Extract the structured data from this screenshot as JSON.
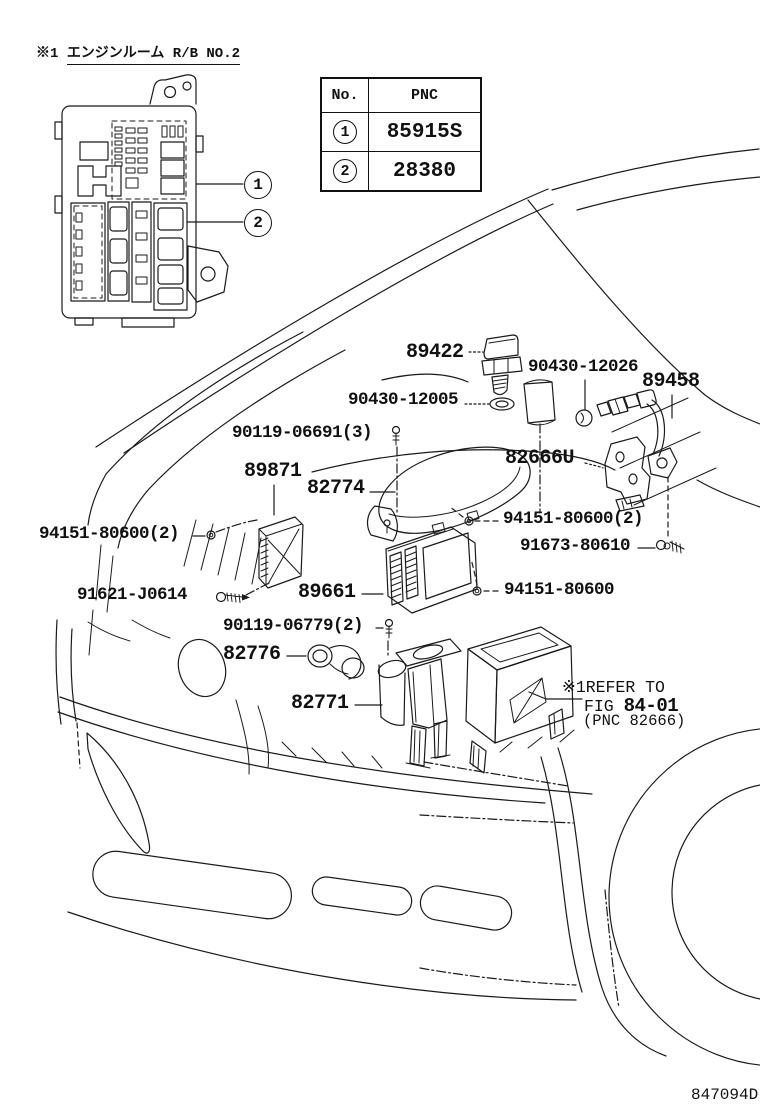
{
  "header": {
    "prefix": "※1",
    "title": "エンジンルーム R/B NO.2"
  },
  "table": {
    "col_no": "No.",
    "col_pnc": "PNC",
    "rows": [
      {
        "no": "1",
        "pnc": "85915S"
      },
      {
        "no": "2",
        "pnc": "28380"
      }
    ]
  },
  "callouts": {
    "c1": "1",
    "c2": "2"
  },
  "part_labels": [
    {
      "id": "89422",
      "text": "89422",
      "x": 406,
      "y": 343,
      "size": "big"
    },
    {
      "id": "90430-12026",
      "text": "90430-12026",
      "x": 528,
      "y": 359,
      "size": "small"
    },
    {
      "id": "89458",
      "text": "89458",
      "x": 642,
      "y": 372,
      "size": "big"
    },
    {
      "id": "90430-12005",
      "text": "90430-12005",
      "x": 348,
      "y": 392,
      "size": "small"
    },
    {
      "id": "90119-06691",
      "text": "90119-06691(3)",
      "x": 232,
      "y": 425,
      "size": "small"
    },
    {
      "id": "89871",
      "text": "89871",
      "x": 244,
      "y": 462,
      "size": "big"
    },
    {
      "id": "82774",
      "text": "82774",
      "x": 307,
      "y": 479,
      "size": "big"
    },
    {
      "id": "82666U",
      "text": "82666U",
      "x": 505,
      "y": 449,
      "size": "big"
    },
    {
      "id": "94151-80600-2-right",
      "text": "94151-80600(2)",
      "x": 503,
      "y": 511,
      "size": "small"
    },
    {
      "id": "91673-80610",
      "text": "91673-80610",
      "x": 520,
      "y": 538,
      "size": "small"
    },
    {
      "id": "94151-80600-2-left",
      "text": "94151-80600(2)",
      "x": 39,
      "y": 526,
      "size": "small"
    },
    {
      "id": "91621-J0614",
      "text": "91621-J0614",
      "x": 77,
      "y": 587,
      "size": "small"
    },
    {
      "id": "89661",
      "text": "89661",
      "x": 298,
      "y": 583,
      "size": "big"
    },
    {
      "id": "94151-80600-right",
      "text": "94151-80600",
      "x": 504,
      "y": 582,
      "size": "small"
    },
    {
      "id": "90119-06779",
      "text": "90119-06779(2)",
      "x": 223,
      "y": 618,
      "size": "small"
    },
    {
      "id": "82776",
      "text": "82776",
      "x": 223,
      "y": 645,
      "size": "big"
    },
    {
      "id": "82771",
      "text": "82771",
      "x": 291,
      "y": 694,
      "size": "big"
    }
  ],
  "note": {
    "line1": "※1REFER TO",
    "fig_prefix": "FIG ",
    "fig": "84-01",
    "line3": "(PNC 82666)"
  },
  "doc_number": "847094D",
  "colors": {
    "ink": "#1a1a1a",
    "bg": "#ffffff"
  }
}
